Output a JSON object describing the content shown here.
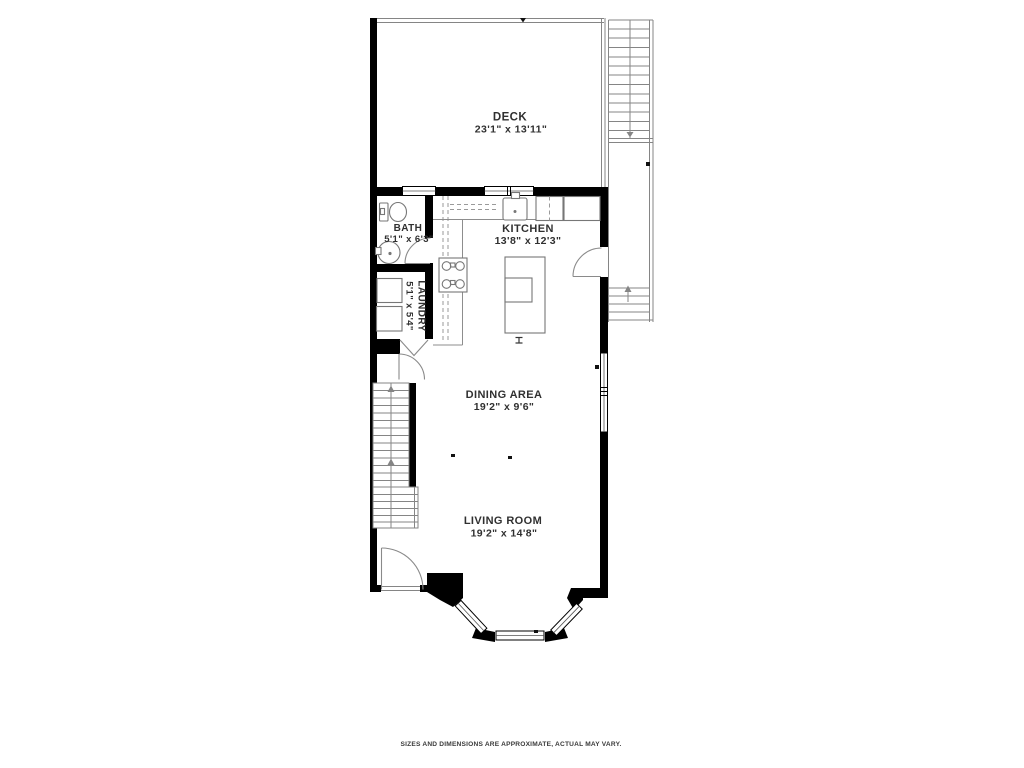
{
  "plan": {
    "rooms": [
      {
        "name": "DECK",
        "dims": "23'1\" x 13'11\""
      },
      {
        "name": "BATH",
        "dims": "5'1\" x 6'3\""
      },
      {
        "name": "KITCHEN",
        "dims": "13'8\" x 12'3\""
      },
      {
        "name": "LAUNDRY",
        "dims": "5'1\" x 5'4\""
      },
      {
        "name": "DINING AREA",
        "dims": "19'2\" x 9'6\""
      },
      {
        "name": "LIVING ROOM",
        "dims": "19'2\" x 14'8\""
      }
    ],
    "footer_note": "SIZES AND DIMENSIONS ARE APPROXIMATE, ACTUAL MAY VARY.",
    "colors": {
      "wall": "#000000",
      "thin_line": "#858585",
      "fixture_line": "#777777",
      "label_text": "#303030",
      "background": "#ffffff"
    }
  }
}
